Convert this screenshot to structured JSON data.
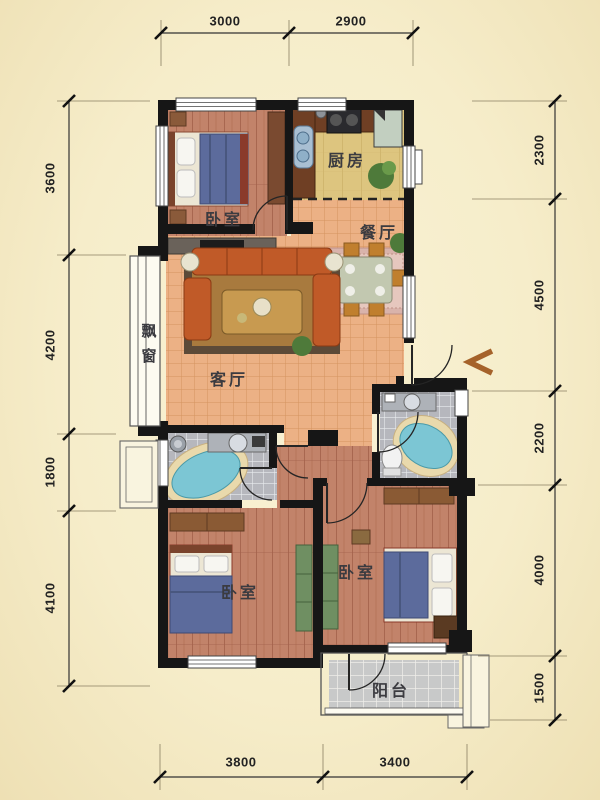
{
  "meta": {
    "type": "residential-floor-plan",
    "language": "zh-CN"
  },
  "rooms": {
    "bedroom_top": {
      "label": "卧室"
    },
    "kitchen": {
      "label": "厨房"
    },
    "dining": {
      "label": "餐厅"
    },
    "living": {
      "label": "客厅"
    },
    "bay_window": {
      "label": "飘窗"
    },
    "bedroom_bottom_left": {
      "label": "卧室"
    },
    "bedroom_bottom_right": {
      "label": "卧室"
    },
    "balcony": {
      "label": "阳台"
    }
  },
  "dimensions": {
    "top": [
      "3000",
      "2900"
    ],
    "bottom": [
      "3800",
      "3400"
    ],
    "left": [
      "3600",
      "4200",
      "1800",
      "4100"
    ],
    "right": [
      "2300",
      "4500",
      "2200",
      "4000",
      "1500"
    ]
  },
  "colors": {
    "background": "#f6edca",
    "wall": "#161616",
    "wood_floor": "#c2836a",
    "tile_floor": "#ecb185",
    "kitchen_floor": "#ddc57f",
    "bath_floor": "#b6b7bd",
    "balcony_floor": "#c8c9c9",
    "sofa": "#c05a28",
    "bed_blanket": "#5c6b9c",
    "bathtub": "#7cc6d4",
    "entry_arrow": "#a5622a",
    "dimension_text": "#222222"
  }
}
